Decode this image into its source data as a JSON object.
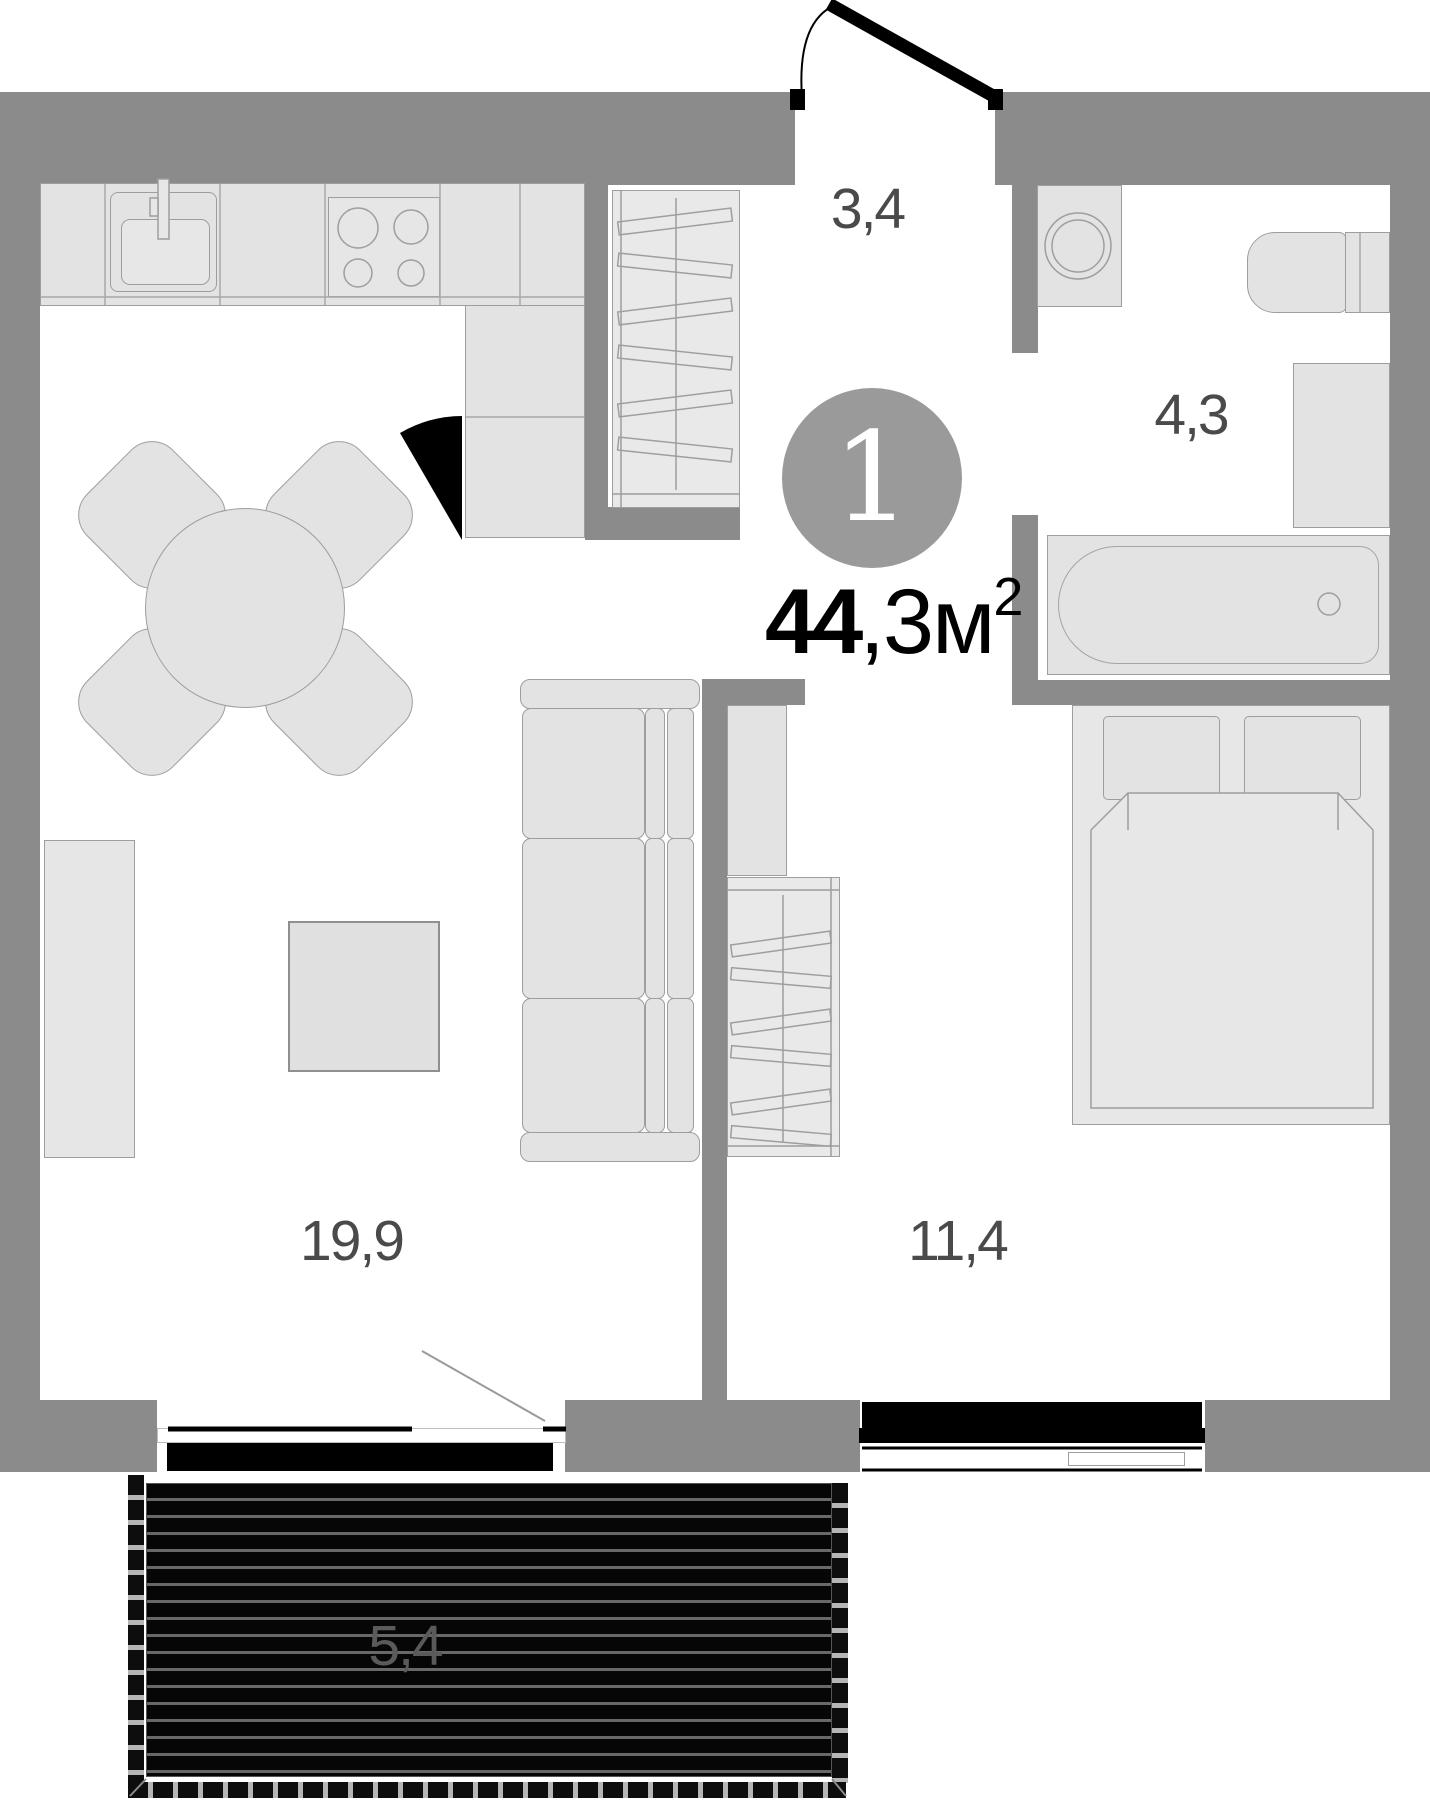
{
  "plan": {
    "badge": {
      "rooms_count": "1"
    },
    "area": {
      "bold": "44",
      "rest": ",3",
      "unit": "м",
      "sup": "2"
    },
    "rooms": [
      {
        "id": "hallway",
        "area": "3,4"
      },
      {
        "id": "bathroom",
        "area": "4,3"
      },
      {
        "id": "living-kitchen",
        "area": "19,9"
      },
      {
        "id": "bedroom",
        "area": "11,4"
      },
      {
        "id": "balcony",
        "area": "5,4"
      }
    ],
    "furniture_icons": [
      "kitchen-counter",
      "kitchen-sink",
      "stove",
      "dining-table",
      "dining-chair",
      "hall-wardrobe",
      "washing-machine",
      "toilet",
      "bathtub",
      "vanity-cabinet",
      "bed",
      "pillow",
      "blanket",
      "bedroom-closet",
      "bedside-cabinet",
      "sofa",
      "tv-stand",
      "coffee-table",
      "entrance-door",
      "balcony-door",
      "window",
      "balcony-deck"
    ],
    "colors": {
      "wall": "#8b8b8b",
      "furniture_fill": "#e3e3e3",
      "outline": "#9e9e9e",
      "badge_bg": "#9a9a9a",
      "room_label": "#4a4a4a",
      "balcony_label": "#5a5a5a",
      "window_black": "#000000"
    }
  }
}
